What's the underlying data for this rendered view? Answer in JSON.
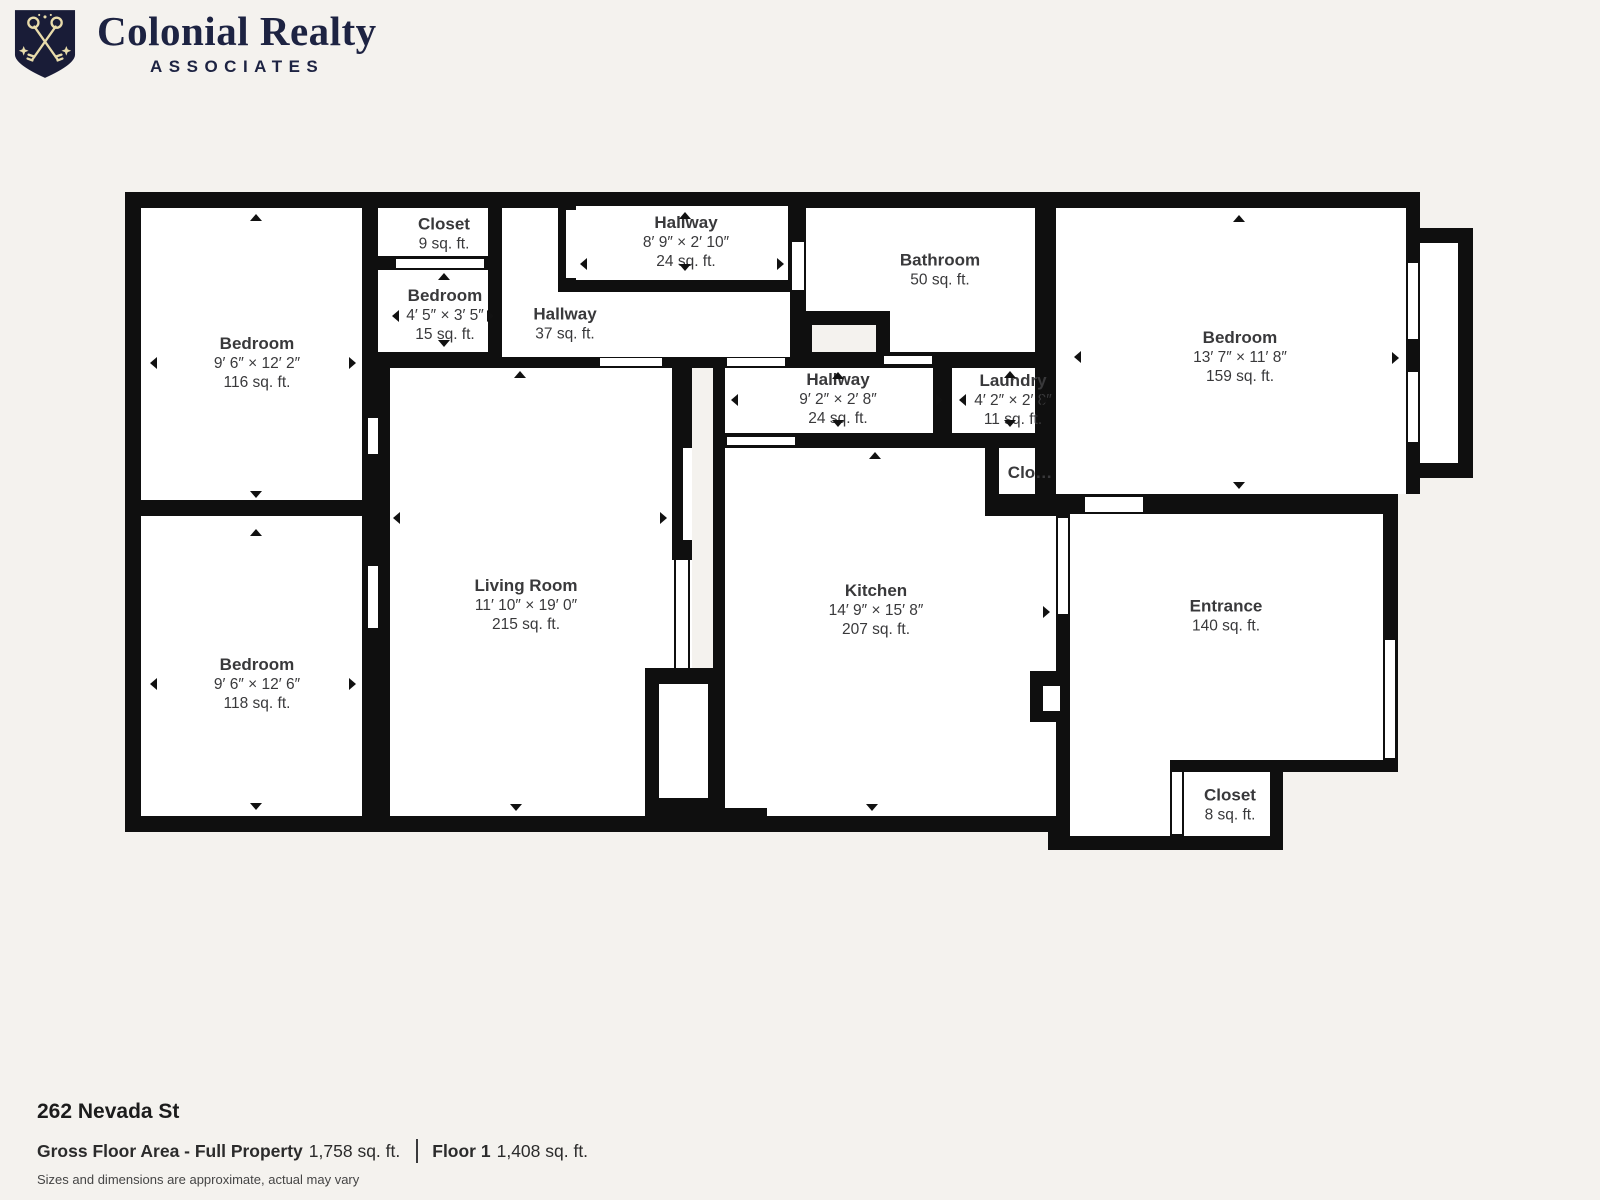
{
  "header": {
    "brand_line1": "Colonial Realty",
    "brand_line2": "ASSOCIATES",
    "logo": {
      "icon": "shield-crossed-keys",
      "bg_color": "#191c37",
      "fg_color": "#e9dcab"
    },
    "text_color": "#1d2342"
  },
  "floorplan": {
    "wall_color": "#0f0f0f",
    "floor_color": "#ffffff",
    "outside_color": "#f4f2ee",
    "label_color": "#39393b",
    "rects": [
      [
        "k",
        125,
        192,
        931,
        640
      ],
      [
        "k",
        1035,
        192,
        363,
        580
      ],
      [
        "k",
        1390,
        192,
        30,
        302
      ],
      [
        "k",
        1398,
        228,
        75,
        250
      ],
      [
        "k",
        1048,
        760,
        235,
        90
      ],
      [
        "w",
        141,
        208,
        221,
        292
      ],
      [
        "w",
        141,
        516,
        221,
        300
      ],
      [
        "w",
        378,
        208,
        110,
        48
      ],
      [
        "w",
        378,
        270,
        110,
        82
      ],
      [
        "w",
        576,
        206,
        212,
        74
      ],
      [
        "w",
        502,
        208,
        56,
        149
      ],
      [
        "w",
        502,
        292,
        288,
        65
      ],
      [
        "w",
        390,
        368,
        282,
        448
      ],
      [
        "w",
        725,
        368,
        208,
        65
      ],
      [
        "w",
        951,
        368,
        84,
        65
      ],
      [
        "w",
        806,
        208,
        229,
        144
      ],
      [
        "w",
        725,
        448,
        331,
        368
      ],
      [
        "k",
        985,
        433,
        71,
        83
      ],
      [
        "w",
        999,
        448,
        36,
        46
      ],
      [
        "w",
        1056,
        208,
        350,
        286
      ],
      [
        "w",
        1420,
        243,
        38,
        220
      ],
      [
        "w",
        1070,
        514,
        313,
        246
      ],
      [
        "w",
        1070,
        760,
        100,
        76
      ],
      [
        "w",
        1184,
        772,
        86,
        64
      ],
      [
        "k",
        949,
        368,
        3,
        65
      ],
      [
        "k",
        672,
        357,
        20,
        203
      ],
      [
        "w",
        672,
        560,
        20,
        108
      ],
      [
        "k",
        674,
        560,
        2,
        108
      ],
      [
        "k",
        688,
        560,
        2,
        108
      ],
      [
        "w",
        683,
        448,
        9,
        92
      ],
      [
        "g",
        692,
        368,
        21,
        300
      ],
      [
        "k",
        713,
        368,
        12,
        300
      ],
      [
        "k",
        645,
        668,
        80,
        164
      ],
      [
        "w",
        659,
        684,
        49,
        114
      ],
      [
        "k",
        710,
        808,
        57,
        24
      ],
      [
        "k",
        798,
        311,
        92,
        41
      ],
      [
        "g",
        812,
        325,
        64,
        27
      ],
      [
        "k",
        1030,
        671,
        34,
        51
      ],
      [
        "w",
        1043,
        686,
        17,
        25
      ],
      [
        "w",
        396,
        259,
        88,
        9
      ],
      [
        "w",
        566,
        210,
        10,
        68
      ],
      [
        "w",
        792,
        242,
        12,
        48
      ],
      [
        "w",
        884,
        356,
        48,
        8
      ],
      [
        "w",
        727,
        437,
        68,
        8
      ],
      [
        "w",
        1058,
        518,
        10,
        96
      ],
      [
        "w",
        1085,
        497,
        58,
        15
      ],
      [
        "w",
        1385,
        640,
        10,
        118
      ],
      [
        "w",
        1172,
        772,
        10,
        62
      ],
      [
        "w",
        1408,
        263,
        10,
        76
      ],
      [
        "w",
        1408,
        372,
        10,
        70
      ],
      [
        "w",
        368,
        566,
        10,
        62
      ],
      [
        "w",
        368,
        418,
        10,
        36
      ],
      [
        "w",
        600,
        358,
        62,
        8
      ],
      [
        "w",
        727,
        358,
        58,
        8
      ]
    ],
    "rooms": [
      {
        "name": "Bedroom",
        "dims": "9′ 6″ × 12′ 2″",
        "area": "116 sq. ft.",
        "cx": 257,
        "cy": 363
      },
      {
        "name": "Bedroom",
        "dims": "9′ 6″ × 12′ 6″",
        "area": "118 sq. ft.",
        "cx": 257,
        "cy": 684
      },
      {
        "name": "Closet",
        "dims": "",
        "area": "9 sq. ft.",
        "cx": 444,
        "cy": 234
      },
      {
        "name": "Bedroom",
        "dims": "4′ 5″ × 3′ 5″",
        "area": "15 sq. ft.",
        "cx": 445,
        "cy": 315
      },
      {
        "name": "Hallway",
        "dims": "8′ 9″ × 2′ 10″",
        "area": "24 sq. ft.",
        "cx": 686,
        "cy": 242
      },
      {
        "name": "Hallway",
        "dims": "",
        "area": "37 sq. ft.",
        "cx": 565,
        "cy": 324
      },
      {
        "name": "Bathroom",
        "dims": "",
        "area": "50 sq. ft.",
        "cx": 940,
        "cy": 270
      },
      {
        "name": "Hallway",
        "dims": "9′ 2″ × 2′ 8″",
        "area": "24 sq. ft.",
        "cx": 838,
        "cy": 399
      },
      {
        "name": "Laundry",
        "dims": "4′ 2″ × 2′ 8″",
        "area": "11 sq. ft.",
        "cx": 1013,
        "cy": 400
      },
      {
        "name": "Clo…",
        "dims": "",
        "area": "",
        "cx": 1030,
        "cy": 473
      },
      {
        "name": "Bedroom",
        "dims": "13′ 7″ × 11′ 8″",
        "area": "159 sq. ft.",
        "cx": 1240,
        "cy": 357
      },
      {
        "name": "Living Room",
        "dims": "11′ 10″ × 19′ 0″",
        "area": "215 sq. ft.",
        "cx": 526,
        "cy": 605
      },
      {
        "name": "Kitchen",
        "dims": "14′ 9″ × 15′ 8″",
        "area": "207 sq. ft.",
        "cx": 876,
        "cy": 610
      },
      {
        "name": "Entrance",
        "dims": "",
        "area": "140 sq. ft.",
        "cx": 1226,
        "cy": 616
      },
      {
        "name": "Closet",
        "dims": "",
        "area": "8 sq. ft.",
        "cx": 1230,
        "cy": 805
      }
    ],
    "arrows": [
      [
        "u",
        256,
        214
      ],
      [
        "d",
        256,
        498
      ],
      [
        "l",
        150,
        363
      ],
      [
        "r",
        356,
        363
      ],
      [
        "u",
        256,
        529
      ],
      [
        "d",
        256,
        810
      ],
      [
        "l",
        150,
        684
      ],
      [
        "r",
        356,
        684
      ],
      [
        "u",
        444,
        273
      ],
      [
        "d",
        444,
        347
      ],
      [
        "l",
        392,
        316
      ],
      [
        "r",
        494,
        316
      ],
      [
        "u",
        685,
        212
      ],
      [
        "d",
        685,
        271
      ],
      [
        "l",
        580,
        264
      ],
      [
        "r",
        784,
        264
      ],
      [
        "u",
        520,
        371
      ],
      [
        "d",
        516,
        811
      ],
      [
        "l",
        393,
        518
      ],
      [
        "r",
        667,
        518
      ],
      [
        "u",
        838,
        372
      ],
      [
        "d",
        838,
        427
      ],
      [
        "l",
        731,
        400
      ],
      [
        "r",
        943,
        400
      ],
      [
        "u",
        1010,
        371
      ],
      [
        "d",
        1010,
        427
      ],
      [
        "l",
        959,
        400
      ],
      [
        "r",
        1048,
        400
      ],
      [
        "u",
        875,
        452
      ],
      [
        "d",
        872,
        811
      ],
      [
        "r",
        1050,
        612
      ],
      [
        "u",
        1239,
        215
      ],
      [
        "d",
        1239,
        489
      ],
      [
        "l",
        1074,
        357
      ],
      [
        "r",
        1399,
        358
      ]
    ]
  },
  "footer": {
    "address": "262 Nevada St",
    "gross_label": "Gross Floor Area - Full Property",
    "gross_value": "1,758 sq. ft.",
    "floor_label": "Floor 1",
    "floor_value": "1,408 sq. ft.",
    "disclaimer": "Sizes and dimensions are approximate, actual may vary"
  }
}
